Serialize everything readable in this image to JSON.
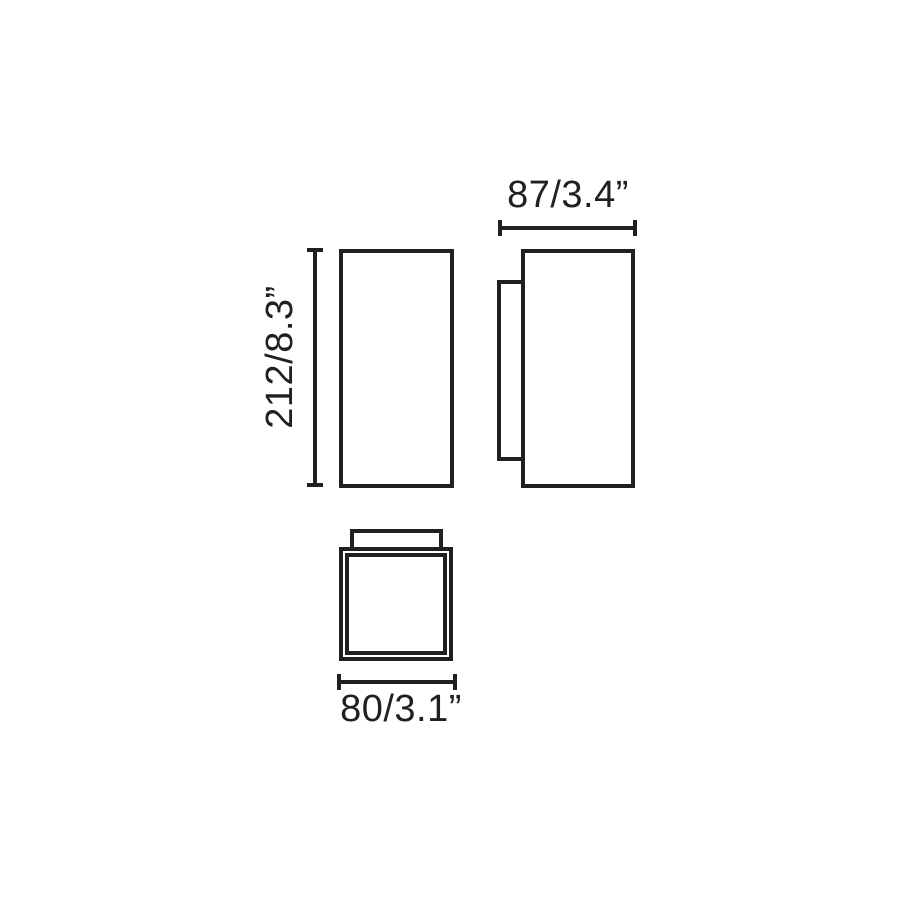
{
  "drawing": {
    "type": "technical-dimension-drawing",
    "subject": "rectangular wall luminaire, three orthographic views",
    "colors": {
      "line": "#231f20",
      "background": "#ffffff"
    },
    "dimensions": {
      "height_label": "212/8.3”",
      "depth_label": "87/3.4”",
      "width_label": "80/3.1”"
    }
  }
}
